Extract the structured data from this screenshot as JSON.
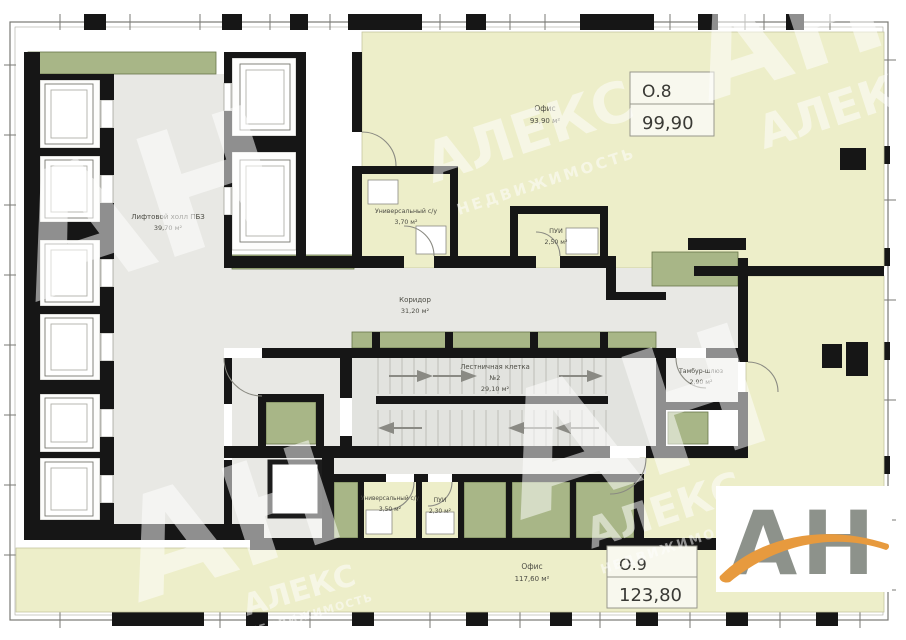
{
  "units": {
    "o8": {
      "number": "О.8",
      "total_area": "99,90"
    },
    "o9": {
      "number": "О.9",
      "total_area": "123,80"
    }
  },
  "rooms": {
    "office_top": {
      "name": "Офис",
      "area": "93,90 м²"
    },
    "office_bottom": {
      "name": "Офис",
      "area": "117,60 м²"
    },
    "lift_hall": {
      "name": "Лифтовой холл ПБЗ",
      "area": "39,70 м²"
    },
    "corridor": {
      "name": "Коридор",
      "area": "31,20 м²"
    },
    "staircase": {
      "name": "Лестничная клетка",
      "number": "№2",
      "area": "29,10 м²"
    },
    "vestibule": {
      "name": "Тамбур-шлюз",
      "area": "2,90 м²"
    },
    "wc_top": {
      "name": "Универсальный с/у",
      "area": "3,70 м²"
    },
    "cleaning_top": {
      "name": "ПУИ",
      "area": "2,50 м²"
    },
    "wc_bottom": {
      "name": "Универсальный с/у",
      "area": "3,50 м²"
    },
    "cleaning_bottom": {
      "name": "ПУИ",
      "area": "2,30 м²"
    }
  },
  "watermark": {
    "letters": "АН",
    "brand": "АЛЕКС",
    "brand_sub": "НЕДВИЖИМОСТЬ"
  },
  "logo": {
    "letters": "АН"
  },
  "colors": {
    "office_fill": "#edeec9",
    "hall_fill": "#e8e8e4",
    "green": "#a8b687",
    "wall": "#161616",
    "accent_orange": "#e79a3e",
    "logo_gray": "#8d928b"
  }
}
